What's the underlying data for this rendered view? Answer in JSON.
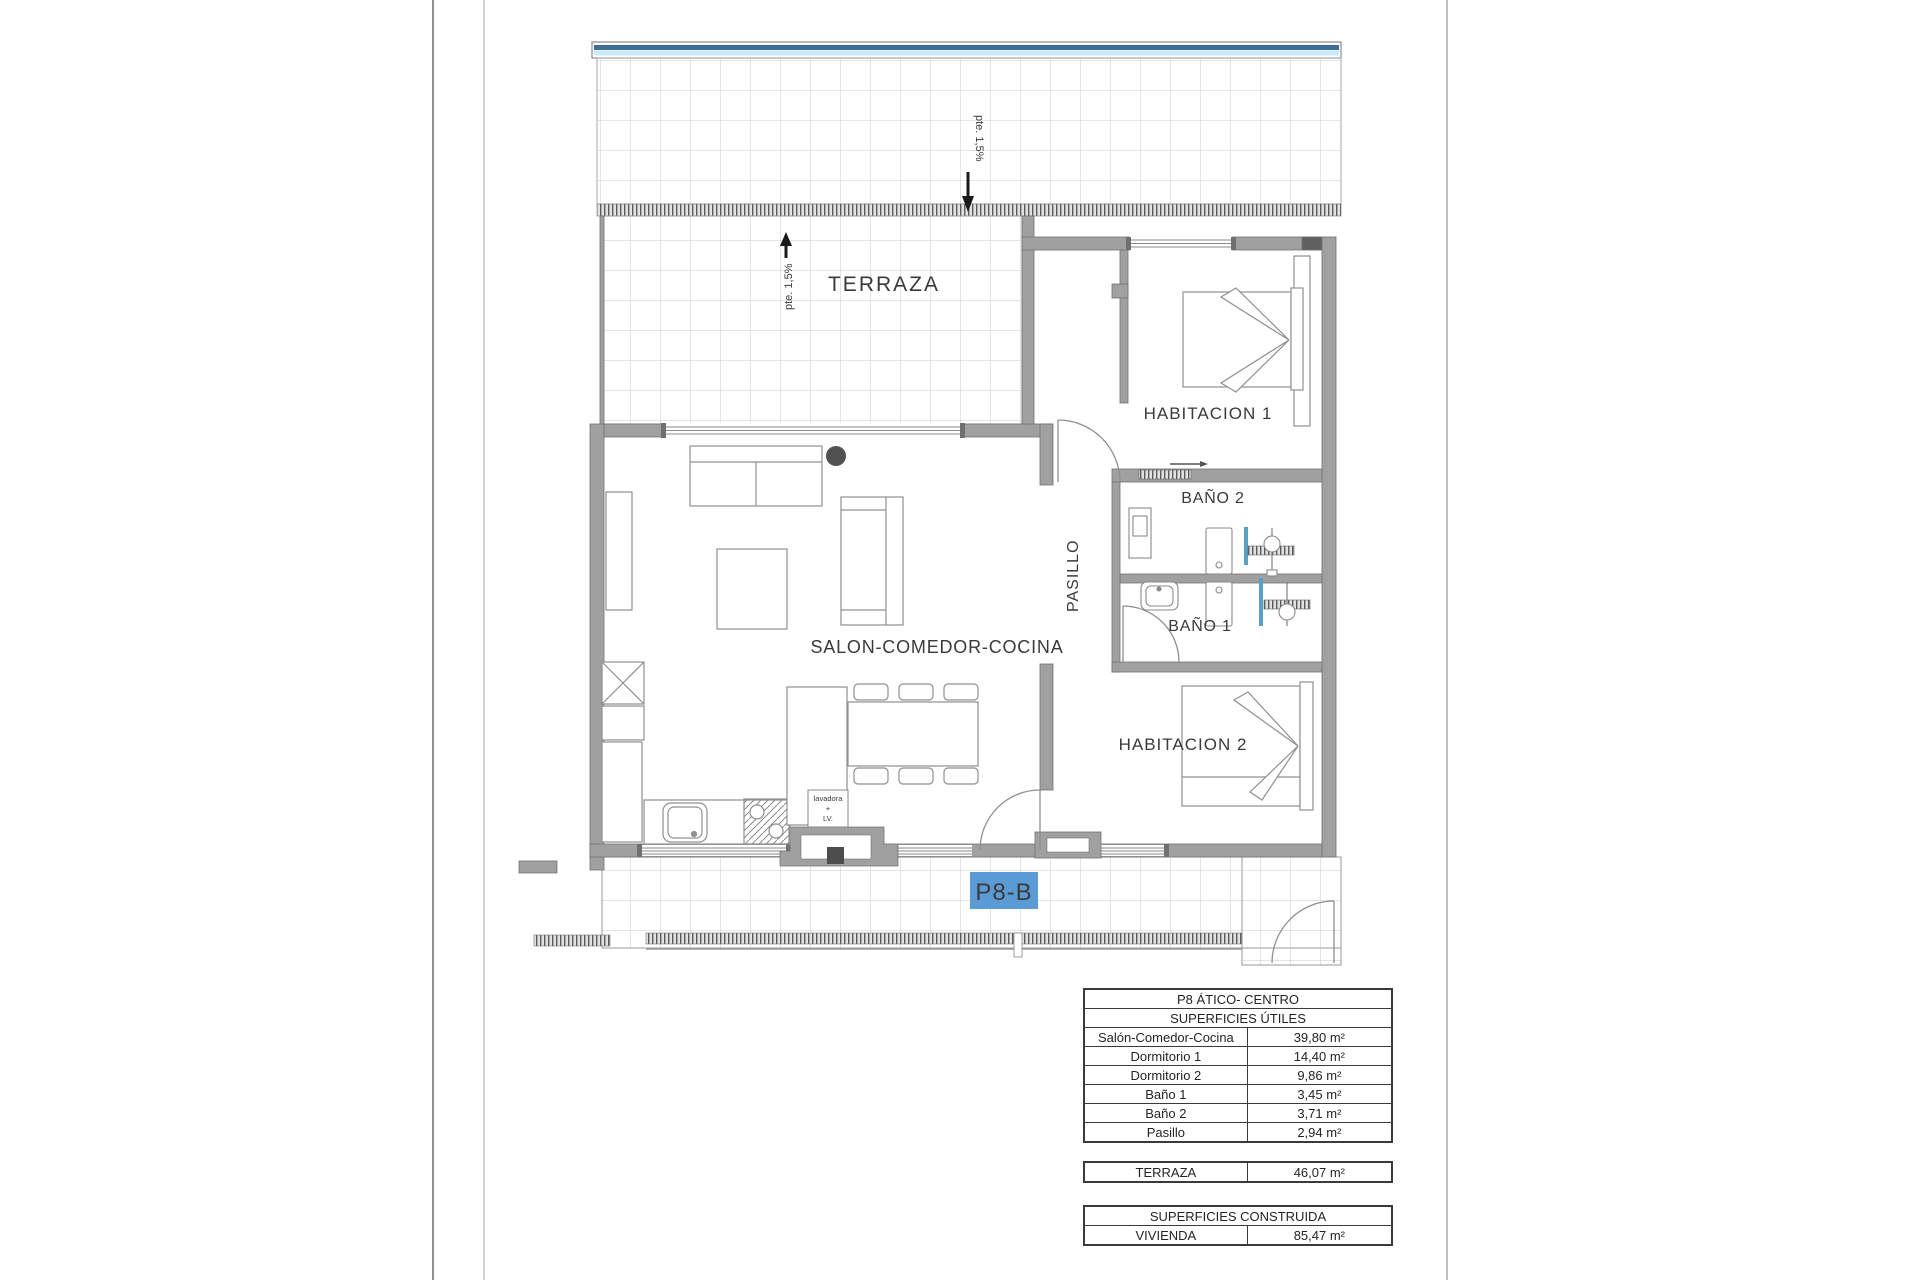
{
  "plan": {
    "unit_label": "P8-B",
    "rooms": {
      "terraza": "TERRAZA",
      "habitacion1": "HABITACION 1",
      "habitacion2": "HABITACION 2",
      "bano1": "BAÑO 1",
      "bano2": "BAÑO 2",
      "pasillo": "PASILLO",
      "salon": "SALON-COMEDOR-COCINA"
    },
    "annotations": {
      "slope": "pte. 1,5%",
      "laundry_line1": "lavadora",
      "laundry_line2": "+",
      "laundry_line3": "LV."
    },
    "colors": {
      "unit_badge_blue": "#5b9bd5",
      "canopy_dark_blue": "#3c6f94",
      "canopy_light_blue": "#c8e9f6",
      "wall_gray": "#a0a0a0",
      "glass_blue": "#58a0c4"
    }
  },
  "tables": {
    "title": "P8 ÁTICO- CENTRO",
    "utiles": {
      "header": "SUPERFICIES ÚTILES",
      "rows": [
        {
          "label": "Salón-Comedor-Cocina",
          "value": "39,80 m²"
        },
        {
          "label": "Dormitorio 1",
          "value": "14,40 m²"
        },
        {
          "label": "Dormitorio 2",
          "value": "9,86 m²"
        },
        {
          "label": "Baño 1",
          "value": "3,45 m²"
        },
        {
          "label": "Baño 2",
          "value": "3,71 m²"
        },
        {
          "label": "Pasillo",
          "value": "2,94 m²"
        }
      ]
    },
    "terraza_row": {
      "label": "TERRAZA",
      "value": "46,07 m²"
    },
    "construida": {
      "header": "SUPERFICIES CONSTRUIDA",
      "row": {
        "label": "VIVIENDA",
        "value": "85,47 m²"
      }
    }
  }
}
